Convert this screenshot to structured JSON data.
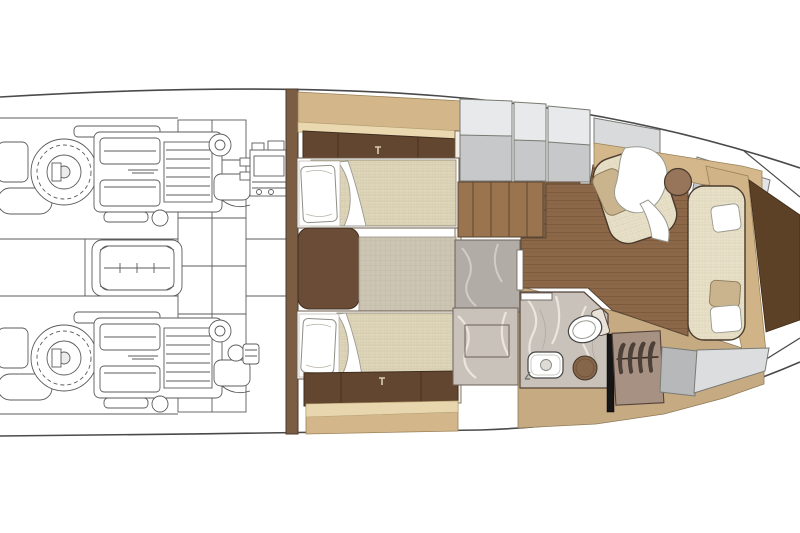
{
  "page": {
    "title": "Motor yacht lower deck floor plan (top-down architectural drawing)"
  },
  "palette": {
    "background": "#ffffff",
    "outline": "#4e4238",
    "hull_line": "#4a4a4a",
    "engine_line_art": "#5b5b5b",
    "wood_floor": "#8c6848",
    "stair_wood": "#9a744e",
    "dark_cabinet": "#63462f",
    "bulkhead_brown": "#7b5d43",
    "tan_panel": "#d3b78b",
    "light_wood_trim": "#ead9b0",
    "mattress_fabric": "#ded6bb",
    "sofa_fabric": "#e8e0c8",
    "counter_light": "#e8e9ea",
    "counter_gray": "#c6c8ca",
    "marble": "#c9c2ba",
    "shower_gray": "#b2aca6",
    "sand_floor": "#c6ab82",
    "wardrobe_taupe": "#a79183",
    "mirror_black": "#161616",
    "bow_wedge_brown": "#5d4126",
    "stool_wood": "#96755a",
    "basin_wood": "#85664a",
    "pillow_white": "#ffffff",
    "pillow_tan": "#c9b48e",
    "rug": "#ccc5b3"
  },
  "rooms": {
    "engine_room": {
      "label": "Engine room (aft, line drawing)",
      "items": [
        "port engine",
        "starboard engine",
        "generator between engines",
        "fuel tank column",
        "bulkhead equipment"
      ]
    },
    "guest_cabin": {
      "label": "Twin guest cabin",
      "items": [
        "upper twin bed with pillow",
        "lower twin bed with pillow",
        "nightstand",
        "rug between beds",
        "overhead cabinet with handle",
        "foot cabinet with handle",
        "tan hull side panels"
      ]
    },
    "companionway": {
      "label": "Companionway stairs",
      "items": [
        "four vertical treads",
        "lower landing steps"
      ]
    },
    "head": {
      "label": "Bathroom (head) and shower",
      "items": [
        "shower compartment with tray",
        "marble floor",
        "toilet",
        "washbasin with faucet",
        "round wooden basin",
        "open door"
      ]
    },
    "galley": {
      "label": "Galley / side counter units",
      "items": [
        "gray counter unit 1",
        "gray counter unit 2",
        "gray counter unit 3",
        "gray counter unit 4",
        "bow counter units"
      ]
    },
    "salon": {
      "label": "Bow salon",
      "items": [
        "teak plank floor",
        "corner armchair with white throw",
        "tan armchair pillow",
        "round stool table",
        "straight sofa with white and tan pillows",
        "sofa back panel",
        "hanging wardrobe with hangers",
        "black mirror panel",
        "aft gray storage units"
      ]
    }
  }
}
